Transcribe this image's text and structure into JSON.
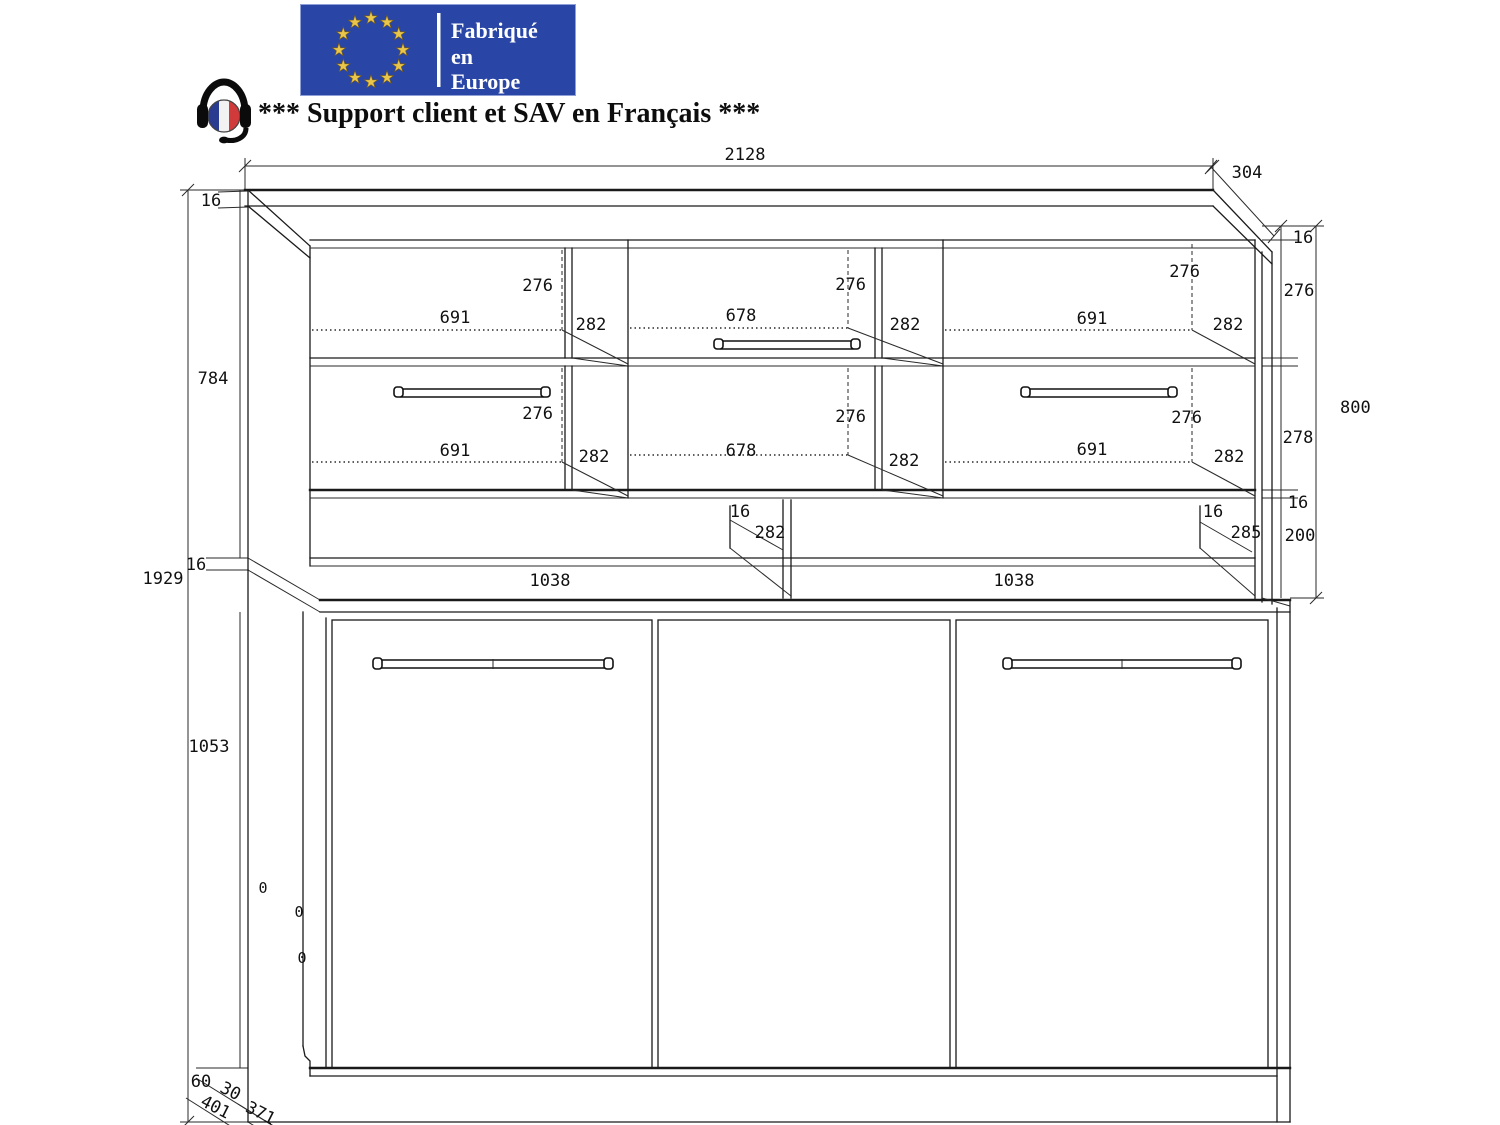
{
  "header": {
    "flag": {
      "line1": "Fabriqué",
      "line2": "en",
      "line3": "Europe",
      "bg_color": "#2946a6",
      "star_color": "#e9c54b"
    },
    "support_text": "*** Support client et SAV en Français ***"
  },
  "drawing": {
    "dims": {
      "total_width": "2128",
      "top_depth": "304",
      "left": {
        "top_16": "16",
        "hutch_inner": "784",
        "total_height": "1929",
        "bottom_16": "16",
        "door_height": "1053",
        "plinth": "60",
        "d30": "30",
        "d401": "401",
        "d371": "371"
      },
      "right": {
        "top_16": "16",
        "row1": "276",
        "hutch_total": "800",
        "row2": "278",
        "mid_16": "16",
        "gap": "200"
      },
      "row1": {
        "left": {
          "h": "276",
          "w": "691",
          "d": "282"
        },
        "mid": {
          "h": "276",
          "w": "678",
          "d": "282"
        },
        "right": {
          "h": "276",
          "w": "691",
          "d": "282"
        }
      },
      "row2": {
        "left": {
          "h": "276",
          "w": "691",
          "d": "282"
        },
        "mid": {
          "h": "276",
          "w": "678",
          "d": "282"
        },
        "right": {
          "h": "276",
          "w": "691",
          "d": "282"
        }
      },
      "shelf": {
        "center_thickness": "16",
        "center_depth": "282",
        "right_thickness": "16",
        "right_depth": "285",
        "left_width": "1038",
        "right_width": "1038"
      },
      "zeros": {
        "z1": "0",
        "z2": "0",
        "z3": "0"
      }
    }
  }
}
